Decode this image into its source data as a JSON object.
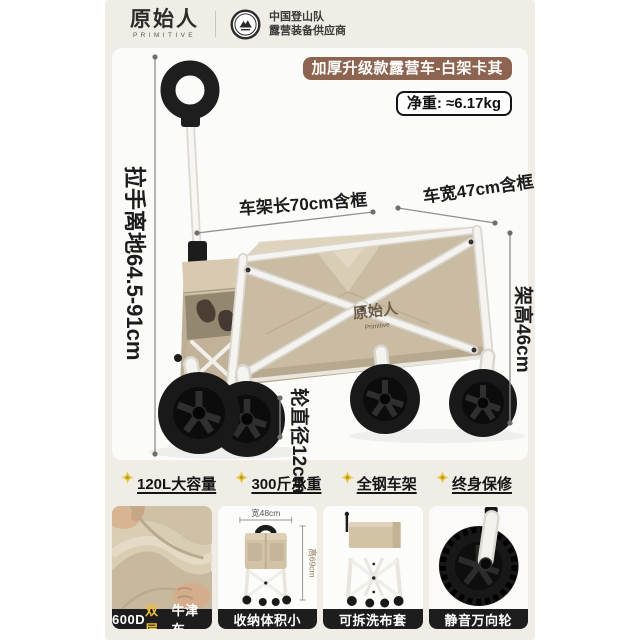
{
  "header": {
    "brand": "原始人",
    "brand_sub": "PRIMITIVE",
    "badge_line1": "中国登山队",
    "badge_line2": "露营装备供应商"
  },
  "hero": {
    "title": "加厚升级款露营车-白架卡其",
    "net_weight": "净重: ≈6.17kg",
    "product_logo": "原始人",
    "product_logo_sub": "Primitive",
    "dim_handle_height": "拉手离地64.5-91cm",
    "dim_frame_length": "车架长70cm含框",
    "dim_frame_width": "车宽47cm含框",
    "dim_frame_height": "架高46cm",
    "dim_wheel_diameter": "轮直径12cm"
  },
  "features": [
    {
      "label": "120L大容量"
    },
    {
      "label": "300斤承重"
    },
    {
      "label": "全钢车架"
    },
    {
      "label": "终身保修"
    }
  ],
  "gallery": {
    "card1": {
      "label_prefix": "600D",
      "label_highlight": "双层",
      "label_suffix": "牛津布"
    },
    "card2": {
      "label": "收纳体积小",
      "dim_width": "宽48cm",
      "dim_height": "高69cm"
    },
    "card3": {
      "label": "可拆洗布套"
    },
    "card4": {
      "label": "静音万向轮"
    }
  },
  "colors": {
    "banner_brown": "#8d6450",
    "khaki": "#cabca2",
    "highlight_yellow": "#eebc3f",
    "caption_bar": "#1d1d1d"
  }
}
